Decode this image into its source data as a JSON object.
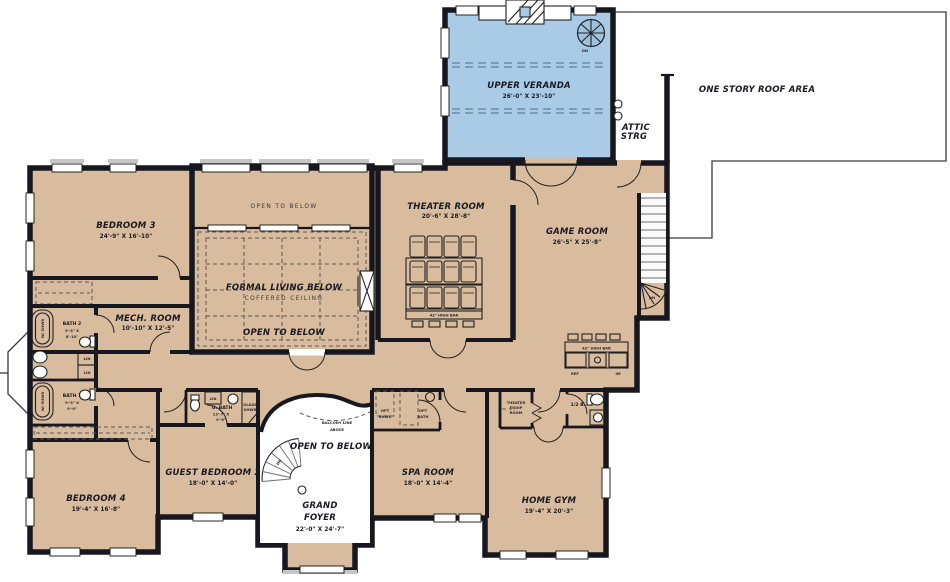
{
  "plan": {
    "colors": {
      "floor": "#d8bc9d",
      "veranda": "#a9cbe5",
      "wall": "#17171f",
      "stair": "#9dc2de"
    },
    "labels": {
      "veranda_name": "UPPER VERANDA",
      "veranda_dims": "26'-0\" X 23'-10\"",
      "roof_area": "ONE STORY ROOF AREA",
      "attic_1": "ATTIC",
      "attic_2": "STRG",
      "bed3_name": "BEDROOM 3",
      "bed3_dims": "24'-9\" X 16'-10\"",
      "open_top": "OPEN TO BELOW",
      "formal": "FORMAL LIVING BELOW",
      "coffered": "COFFERED CEILING",
      "open_mid": "OPEN TO BELOW",
      "theater_name": "THEATER ROOM",
      "theater_dims": "20'-6\" X 28'-8\"",
      "game_name": "GAME ROOM",
      "game_dims": "26'-5\" X 25'-8\"",
      "mech_name": "MECH. ROOM",
      "mech_dims": "10'-10\" X 12'-5\"",
      "bath2_name": "BATH 2",
      "bath2_d1": "9'-3\" X",
      "bath2_d2": "8'-10\"",
      "bath1_name": "BATH 1",
      "bath1_d1": "9'-3\" X",
      "bath1_d2": "9'-0\"",
      "lin": "LIN",
      "gbath_name": "G. BATH",
      "gbath_d1": "13'-7\" X",
      "gbath_d2": "9'-0\"",
      "glass_1": "GLASS",
      "glass_2": "SHWR",
      "guest_name": "GUEST BEDROOM 2",
      "guest_dims": "18'-0\" X 14'-0\"",
      "bed4_name": "BEDROOM 4",
      "bed4_dims": "19'-4\" X 16'-8\"",
      "balcony_1": "BALCONY LINE",
      "balcony_2": "ABOVE",
      "open_foyer": "OPEN TO BELOW",
      "foyer_1": "GRAND",
      "foyer_2": "FOYER",
      "foyer_dims": "22'-0\" X 24'-7\"",
      "spa_name": "SPA ROOM",
      "spa_dims": "18'-0\" X 14'-4\"",
      "opt_1": "OPT",
      "opt_shwr": "SHWR",
      "opt_2": "OPT",
      "opt_bath": "BATH",
      "equip_1": "THEATER",
      "equip_2": "EQUIP",
      "equip_3": "ROOM",
      "half_bath": "1/2 B.",
      "gym_name": "HOME GYM",
      "gym_dims": "19'-4\" X 20'-3\"",
      "bar_theater": "42\" HIGH BAR",
      "bar_game": "42\" HIGH BAR",
      "ref": "REF",
      "im": "IM",
      "dn": "DN",
      "w_shwr": "W/ SHWR"
    }
  }
}
